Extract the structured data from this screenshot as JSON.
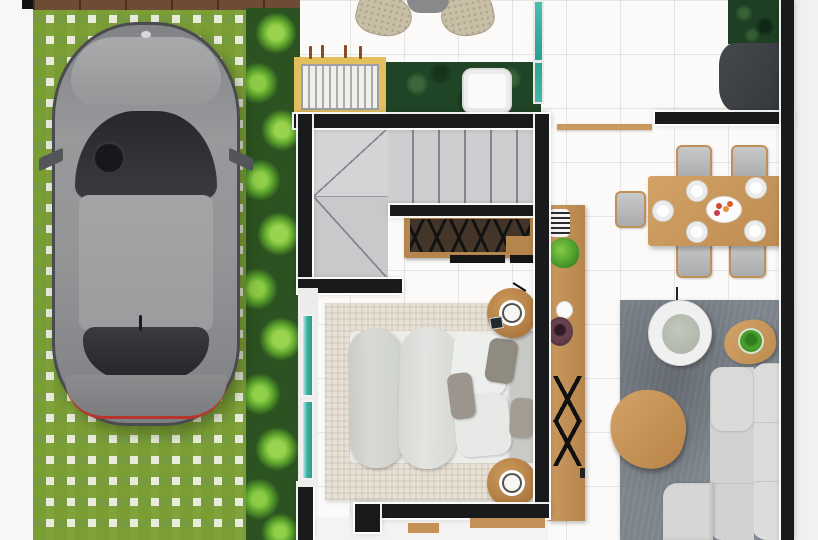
{
  "scene": {
    "title": "3D apartment floor plan - top view render",
    "no_visible_text": true,
    "areas": [
      {
        "name": "driveway",
        "surface": "grass-block-pavers",
        "objects": [
          "grey-car-top-view",
          "hedge-row",
          "wood-deck-edge",
          "side-walkway"
        ]
      },
      {
        "name": "terrace",
        "objects": [
          "bean-bag-chair-left",
          "bean-bag-chair-right",
          "outdoor-table",
          "yellow-border-drain-mat",
          "dark-green-planter-bed",
          "white-tray-table",
          "teal-glass-partition"
        ]
      },
      {
        "name": "staircase",
        "objects": [
          "straight-run-treads",
          "winder-landing-upper",
          "winder-landing-lower",
          "wood-shoe-console"
        ]
      },
      {
        "name": "bedroom",
        "objects": [
          "double-bed",
          "duvet",
          "pillows",
          "headboard",
          "woven-area-rug",
          "round-nightstand-top",
          "round-nightstand-bottom",
          "clock-tray",
          "photo-stack",
          "sliding-glass-window",
          "door-threshold"
        ]
      },
      {
        "name": "hallway-counter",
        "objects": [
          "wood-desk-strip",
          "striped-cup",
          "potted-plant",
          "white-cup",
          "purple-bowl",
          "x-shaped-legs",
          "wall-shelf"
        ]
      },
      {
        "name": "dining-room",
        "objects": [
          "wood-dining-table",
          "dining-chairs-x5",
          "place-setting-plates-x5",
          "fruit-serving-dish"
        ]
      },
      {
        "name": "living-room",
        "objects": [
          "grey-area-rug",
          "white-swivel-chair",
          "triangular-side-table",
          "green-glass-cup",
          "triangular-coffee-table",
          "l-shaped-sofa",
          "tv-unit",
          "green-plant-wall"
        ]
      }
    ],
    "palette": {
      "wall_black": "#191a1c",
      "floor_tile": "#fbfaf8",
      "wood_tan": "#c49259",
      "grass_green": "#7aa033",
      "leaf_green": "#63aa2e",
      "planter_green": "#1f4526",
      "glass_teal": "#3db1a0",
      "stair_grey": "#cdced0",
      "sofa_grey": "#d6d6d4",
      "living_rug_grey": "#7d848c",
      "bedroom_rug_beige": "#e7e1d5",
      "mat_yellow": "#e3bf5e",
      "car_grey": "#97999b",
      "taillight_red": "#b8352c"
    }
  }
}
